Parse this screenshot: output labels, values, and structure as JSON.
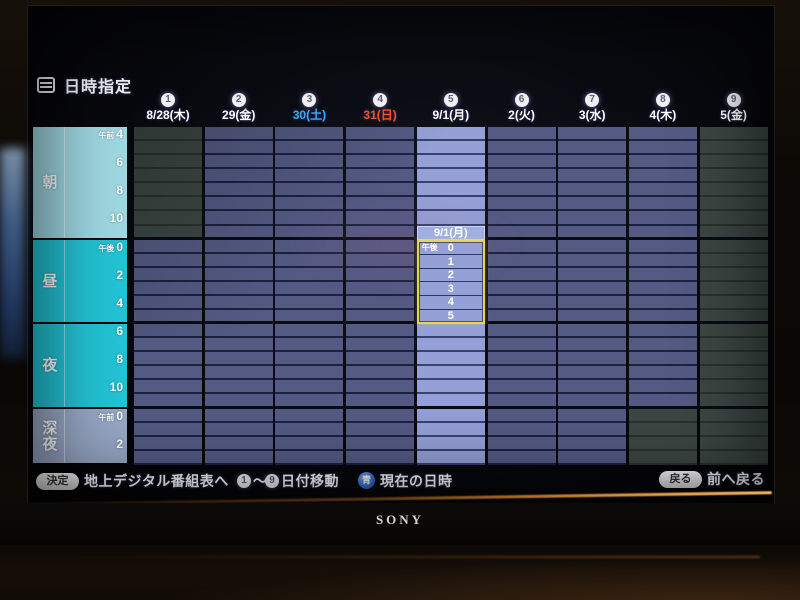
{
  "title_bar": {
    "title": "日時指定"
  },
  "days": [
    {
      "num": "1",
      "label": "8/28(木)",
      "color": "white",
      "unavailable": {
        "from": 0,
        "to": 8
      }
    },
    {
      "num": "2",
      "label": "29(金)",
      "color": "white"
    },
    {
      "num": "3",
      "label": "30(土)",
      "color": "saturday"
    },
    {
      "num": "4",
      "label": "31(日)",
      "color": "sunday"
    },
    {
      "num": "5",
      "label": "9/1(月)",
      "color": "white",
      "selected": true
    },
    {
      "num": "6",
      "label": "2(火)",
      "color": "white"
    },
    {
      "num": "7",
      "label": "3(水)",
      "color": "white"
    },
    {
      "num": "8",
      "label": "4(木)",
      "color": "white",
      "unavailable": {
        "from": 20,
        "to": 24
      }
    },
    {
      "num": "9",
      "label": "5(金)",
      "color": "white",
      "unavailable": {
        "from": 0,
        "to": 24
      }
    }
  ],
  "time_panel": {
    "sections": [
      {
        "id": "morning",
        "name": "朝",
        "rows": 8,
        "labels": [
          [
            "午前",
            "4",
            0
          ],
          [
            "",
            "6",
            2
          ],
          [
            "",
            "8",
            4
          ],
          [
            "",
            "10",
            6
          ]
        ]
      },
      {
        "id": "midday",
        "name": "昼",
        "rows": 6,
        "labels": [
          [
            "午後",
            "0",
            0
          ],
          [
            "",
            "2",
            2
          ],
          [
            "",
            "4",
            4
          ]
        ]
      },
      {
        "id": "evening",
        "name": "夜",
        "rows": 6,
        "labels": [
          [
            "",
            "6",
            0
          ],
          [
            "",
            "8",
            2
          ],
          [
            "",
            "10",
            4
          ]
        ]
      },
      {
        "id": "latenight",
        "name": "深夜",
        "rows": 4,
        "labels": [
          [
            "午前",
            "0",
            0
          ],
          [
            "",
            "2",
            2
          ]
        ]
      }
    ]
  },
  "selection": {
    "day_label": "9/1(月)",
    "column": 5,
    "label_row": 7,
    "start_row": 8,
    "hours": [
      [
        "午後",
        "0"
      ],
      [
        "",
        "1"
      ],
      [
        "",
        "2"
      ],
      [
        "",
        "3"
      ],
      [
        "",
        "4"
      ],
      [
        "",
        "5"
      ]
    ]
  },
  "footer": {
    "decide_button": "決定",
    "decide_action": "地上デジタル番組表へ",
    "range_start": "1",
    "tilde": "～",
    "range_end": "9",
    "range_action": "日付移動",
    "blue_button": "青",
    "blue_action": "現在の日時",
    "back_button": "戻る",
    "back_action": "前へ戻る"
  },
  "tv": {
    "brand": "SONY"
  },
  "colors": {
    "saturday": "#38a9f8",
    "sunday": "#ff4e1e",
    "cell": "#545a84",
    "cell_unavailable": "#3c4743",
    "cell_selected": "#94a0d6",
    "selection_border": "#e9d44f",
    "section_morning": "#9fd8e2",
    "section_midday": "#23c3d5",
    "section_latenight": "#98a8c6",
    "blue_key": "#2f6fd0"
  }
}
